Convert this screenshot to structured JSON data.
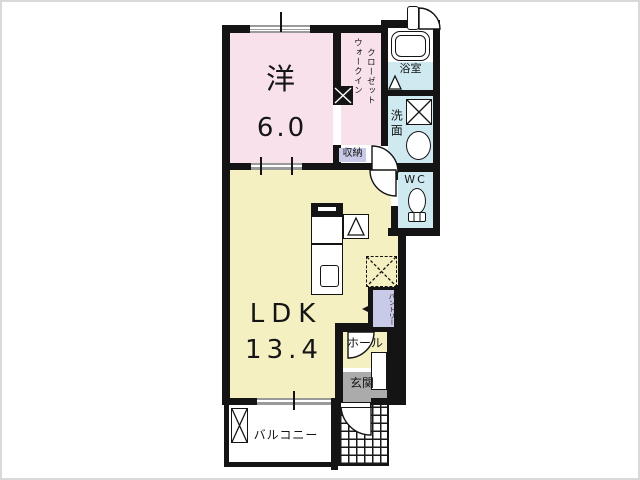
{
  "floorplan": {
    "rooms": {
      "western_room": {
        "name": "洋",
        "size": "6.0"
      },
      "ldk": {
        "name": "LDK",
        "size": "13.4"
      },
      "walk_in_closet": {
        "name_col1": "ウォークイン",
        "name_col2": "クローゼット"
      },
      "storage": {
        "name": "収納"
      },
      "bathroom": {
        "name": "浴室"
      },
      "washroom": {
        "name": "洗面"
      },
      "toilet": {
        "name": "WC"
      },
      "pantry": {
        "name": "パントリー"
      },
      "hall": {
        "name": "ホール"
      },
      "entrance": {
        "name": "玄関"
      },
      "balcony": {
        "name": "バルコニー"
      }
    },
    "colors": {
      "wall": "#141414",
      "room_pink": "#f9e1eb",
      "room_yellow": "#f5f0c1",
      "room_cyan": "#cfe9f1",
      "label_chip_purple": "#c9c9e8",
      "entrance_gray": "#ababab",
      "window_gray": "#9a9a9a"
    },
    "icons": {
      "bathtub": "bathtub-icon",
      "folding_door": "folding-door-icon",
      "washing_machine_pan": "x-box-icon",
      "sink": "oval-basin-icon",
      "toilet": "toilet-icon",
      "kitchen_counter": "kitchen-counter-icon",
      "stove": "stove-icon",
      "range_hood_triangle": "triangle-box-icon",
      "refrigerator_space": "dashed-x-box-icon",
      "pillar": "black-x-square-icon",
      "shoe_cabinet": "diagonal-rect-icon",
      "outdoor_unit": "tall-x-box-icon",
      "door_swing": "quarter-arc-icon",
      "window": "double-line-icon"
    }
  }
}
